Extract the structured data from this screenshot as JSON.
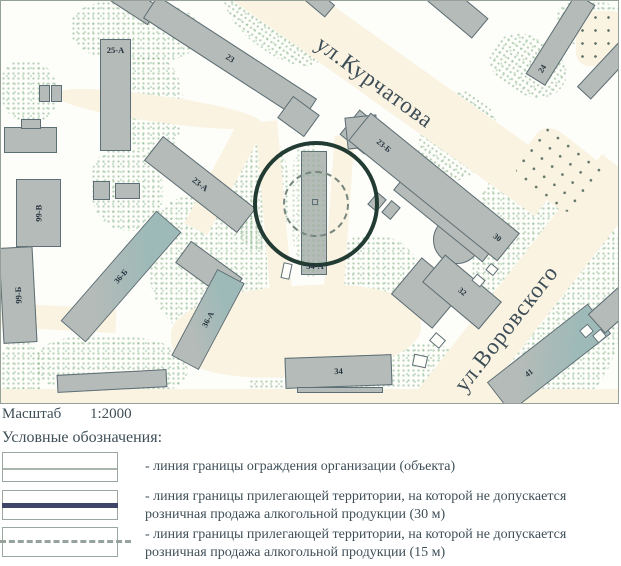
{
  "map": {
    "streets": [
      {
        "name": "ул.Курчатова"
      },
      {
        "name": "ул.Воровского"
      }
    ],
    "buildings": [
      {
        "label": "25-А"
      },
      {
        "label": "23"
      },
      {
        "label": "23-А"
      },
      {
        "label": "23-Б"
      },
      {
        "label": "30"
      },
      {
        "label": "24"
      },
      {
        "label": "99-В"
      },
      {
        "label": "99-Б"
      },
      {
        "label": "36-Б"
      },
      {
        "label": "36-А"
      },
      {
        "label": "34-А"
      },
      {
        "label": "34"
      },
      {
        "label": "32"
      },
      {
        "label": "41"
      }
    ],
    "colors": {
      "building_fill": "#b5bbb8",
      "building_teal": "#9dbab8",
      "road": "#faf3e1",
      "vegetation": "#bcd6b8",
      "fence_line": "#a9b4ad",
      "boundary_30m_line": "#3e4568",
      "boundary_15m_line": "#96a29c",
      "map_circle_30m": "#223b33"
    }
  },
  "scale": {
    "label": "Масштаб",
    "value": "1:2000"
  },
  "legend": {
    "title": "Условные обозначения:",
    "items": [
      {
        "text": "- линия границы ограждения организации (объекта)"
      },
      {
        "text": "- линия границы прилегающей территории, на которой не допускается розничная продажа алкогольной продукции (30 м)"
      },
      {
        "text": "- линия границы прилегающей территории, на которой не допускается розничная продажа алкогольной продукции (15 м)"
      }
    ]
  }
}
